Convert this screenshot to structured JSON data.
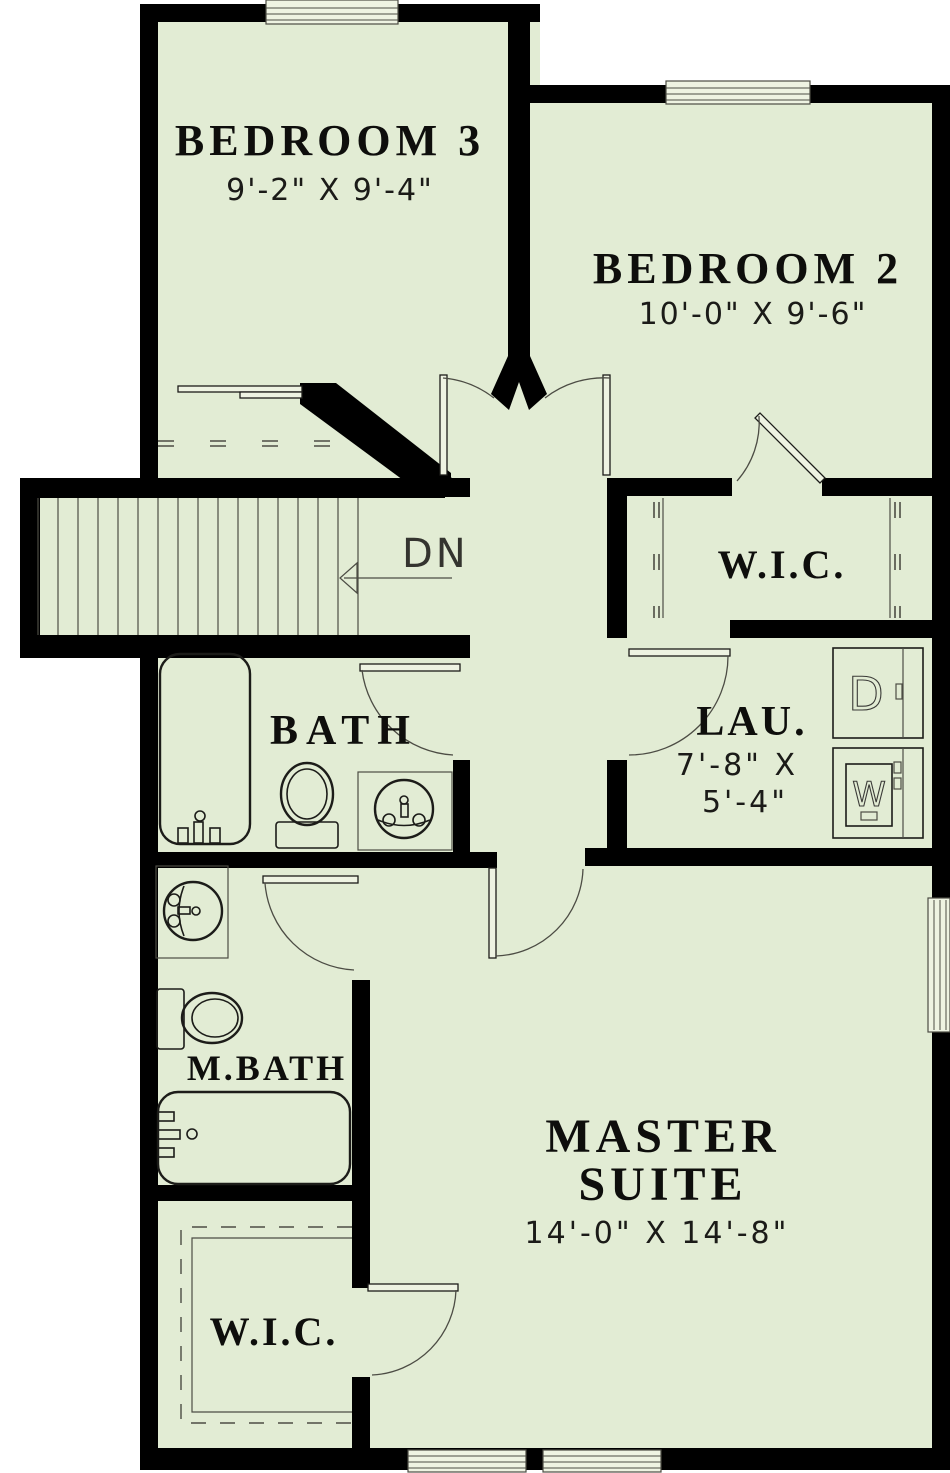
{
  "plan": {
    "rooms": {
      "bedroom3": {
        "label": "BEDROOM 3",
        "dims": "9'-2\" X 9'-4\""
      },
      "bedroom2": {
        "label": "BEDROOM 2",
        "dims": "10'-0\" X 9'-6\""
      },
      "wic_upper": {
        "label": "W.I.C."
      },
      "bath": {
        "label": "BATH"
      },
      "laundry": {
        "label": "LAU.",
        "dims_line1": "7'-8\" X",
        "dims_line2": "5'-4\""
      },
      "master_bath": {
        "label": "M.BATH"
      },
      "master_suite": {
        "label_line1": "MASTER",
        "label_line2": "SUITE",
        "dims": "14'-0\" X 14'-8\""
      },
      "wic_master": {
        "label": "W.I.C."
      }
    },
    "stairs": {
      "direction_label": "DN"
    },
    "appliances": {
      "dryer": "D",
      "washer": "W"
    },
    "colors": {
      "wall": "#000000",
      "floor": "#e2ecd4",
      "lite": "#eef3e2",
      "thin": "#4c4c44",
      "fix": "#1c1c19",
      "ink": "#0e0e0c"
    }
  }
}
